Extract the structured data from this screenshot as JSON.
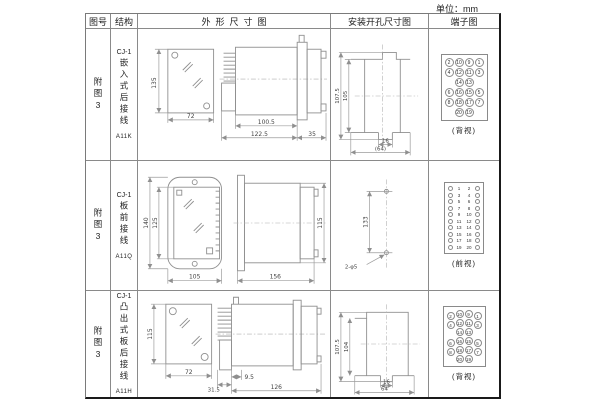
{
  "unit_label": "单位：mm",
  "headers": {
    "fig_no": "图号",
    "structure": "结构",
    "outline": "外形尺寸图",
    "install": "安装开孔尺寸图",
    "terminal": "端子图"
  },
  "rows": [
    {
      "fig_no": "附图3",
      "model": "CJ-1",
      "structure": "嵌入式后接线",
      "code": "A11K",
      "outline": {
        "front_h": "135",
        "front_w": "72",
        "body_len": "100.5",
        "total_len": "122.5",
        "rear_len": "35"
      },
      "install": {
        "v_outer": "107.5",
        "v_inner": "105",
        "h_notch": "16",
        "h_total": "(64)"
      },
      "terminal": {
        "type": "grid4",
        "pins": [
          "2",
          "10",
          "9",
          "1",
          "4",
          "12",
          "11",
          "3",
          "",
          "14",
          "13",
          "",
          "6",
          "16",
          "15",
          "5",
          "8",
          "18",
          "17",
          "7",
          "",
          "20",
          "19",
          ""
        ],
        "caption": "(背视)"
      }
    },
    {
      "fig_no": "附图3",
      "model": "CJ-1",
      "structure": "板前接线",
      "code": "A11Q",
      "outline": {
        "front_h_outer": "140",
        "front_h_inner": "125",
        "front_w": "105",
        "side_len": "156",
        "side_h": "115"
      },
      "install": {
        "v": "133",
        "hole": "2-φ5"
      },
      "terminal": {
        "type": "strip",
        "pins": [
          "1",
          "2",
          "3",
          "4",
          "5",
          "6",
          "7",
          "8",
          "9",
          "10",
          "11",
          "12",
          "13",
          "14",
          "15",
          "16",
          "17",
          "18",
          "19",
          "20"
        ],
        "caption": "(前视)"
      }
    },
    {
      "fig_no": "附图3",
      "model": "CJ-1",
      "structure": "凸出式板后接线",
      "code": "A11H",
      "outline": {
        "front_h": "115",
        "front_w": "72",
        "block_len": "31.5",
        "offset": "9.5",
        "body_len": "126"
      },
      "install": {
        "v_outer": "107.5",
        "v_inner": "104",
        "h_notch": "16",
        "h_total": "64"
      },
      "terminal": {
        "type": "grid4",
        "pins": [
          "2",
          "10",
          "9",
          "1",
          "4",
          "12",
          "11",
          "3",
          "",
          "14",
          "13",
          "",
          "6",
          "16",
          "15",
          "5",
          "8",
          "18",
          "17",
          "7",
          "",
          "20",
          "19",
          ""
        ],
        "caption": "(背视)"
      }
    }
  ]
}
